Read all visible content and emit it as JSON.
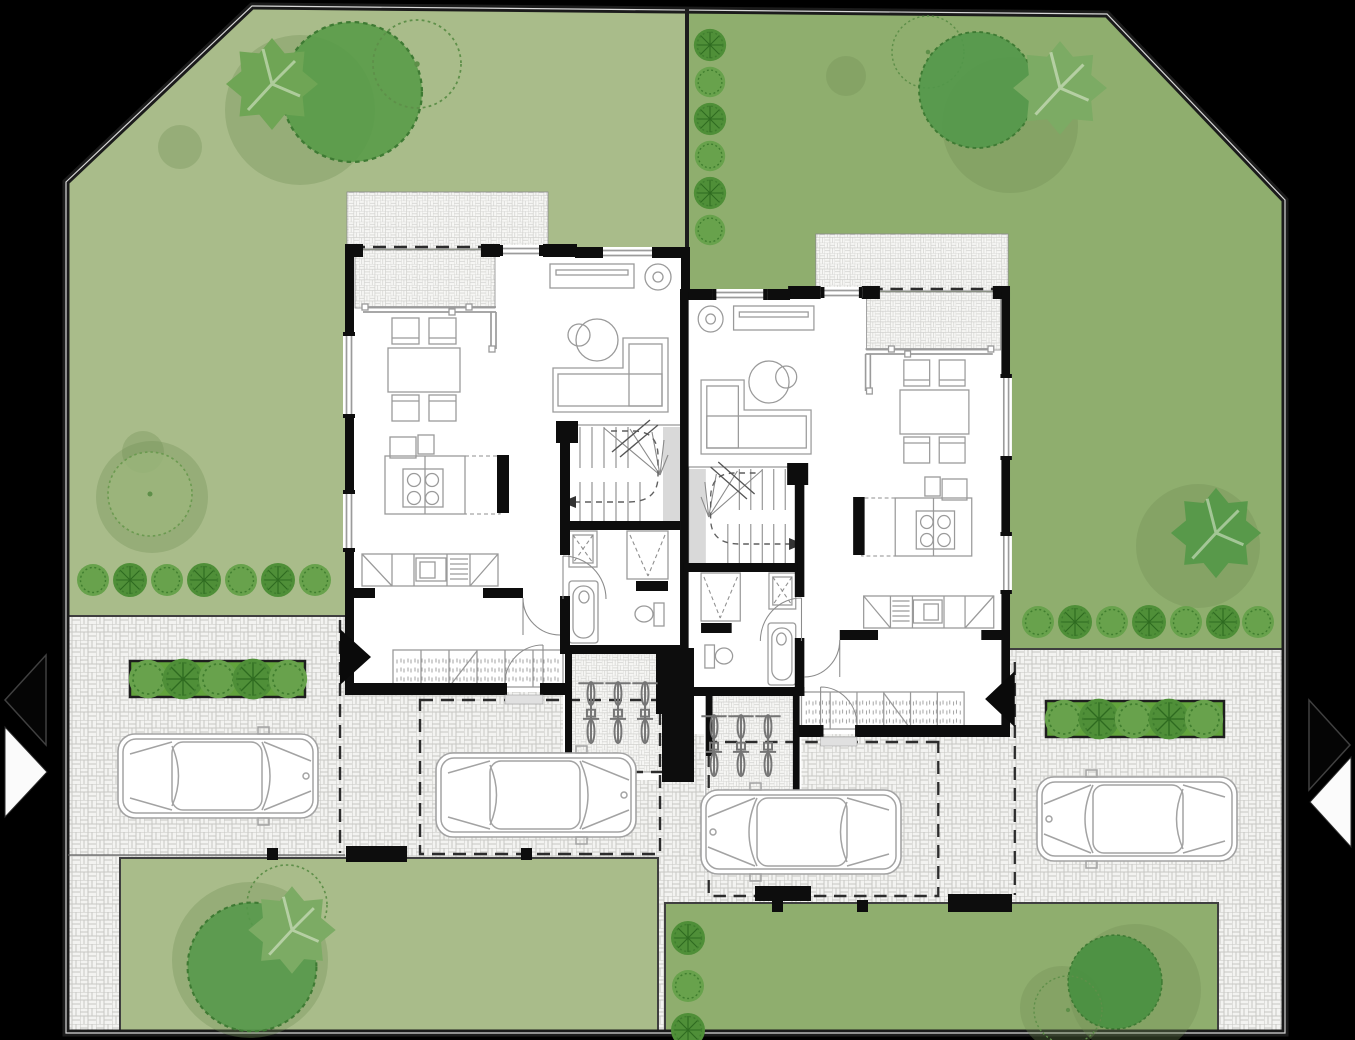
{
  "meta": {
    "title": "Ground-floor architectural site plan — two mirrored semi-detached houses with gardens, driveways, parked cars and bike sheds",
    "visible_text": []
  },
  "colors": {
    "background": "#000000",
    "garden_light": "#a9bc8a",
    "garden_dark": "#8fae6e",
    "tree_dark": "#55984a",
    "tree_mid": "#6fa555",
    "tree_light": "#7cab64",
    "tree_deep": "#479040",
    "shrub_light": "#68a24c",
    "shrub_dark": "#4f8f38",
    "hedge": "#62a33c",
    "paver_base": "#f3f3f1",
    "paver_line": "#c7c7c4",
    "wall": "#0d0d0d",
    "floor": "#ffffff",
    "furniture_line": "#9a9a9a",
    "door_line": "#8c8c8c",
    "stair_line": "#8a8a8a",
    "car_line": "#a3a3a3",
    "bike_line": "#757575",
    "canopy_dash": "#2c2c2c",
    "shadow": "#6f8f55"
  },
  "scene": {
    "type": "architectural site plan, ground floor, top view",
    "buildings": {
      "count": 2,
      "kind": "semi-detached mirrored houses sharing a central party wall",
      "rooms_per_unit": [
        "living-dining room",
        "kitchen with island and 4-burner cooktop",
        "entrance hall with wardrobe",
        "bathroom (bathtub, toilet, shower, washer)",
        "winder staircase",
        "bike shed with 3 bicycles",
        "paved terrace with sliding doors"
      ]
    },
    "vehicles": {
      "cars": 4,
      "bicycles": 6
    },
    "vegetation": {
      "large_canopy_trees": 9,
      "outlined_trees": 4,
      "shrubs_total": 28,
      "hedge_planters": 2,
      "shrub_rows": [
        "7 along left garden edge",
        "7 along right garden edge",
        "6 on garden divider",
        "3 in bottom-right lawn",
        "5 in each hedge planter"
      ]
    },
    "site": {
      "gardens": [
        "large light-green garden (upper left)",
        "large dark-green garden (upper right)",
        "bottom-left lawn",
        "bottom-right lawn"
      ],
      "paving": "basket-weave pavers on driveways, courtyards and terraces",
      "boundary": "dark site outline with chamfered top-left and top-right corners",
      "access_arrows": {
        "left_edge": 2,
        "right_edge": 2,
        "unit_entrance_markers": 2
      }
    }
  }
}
